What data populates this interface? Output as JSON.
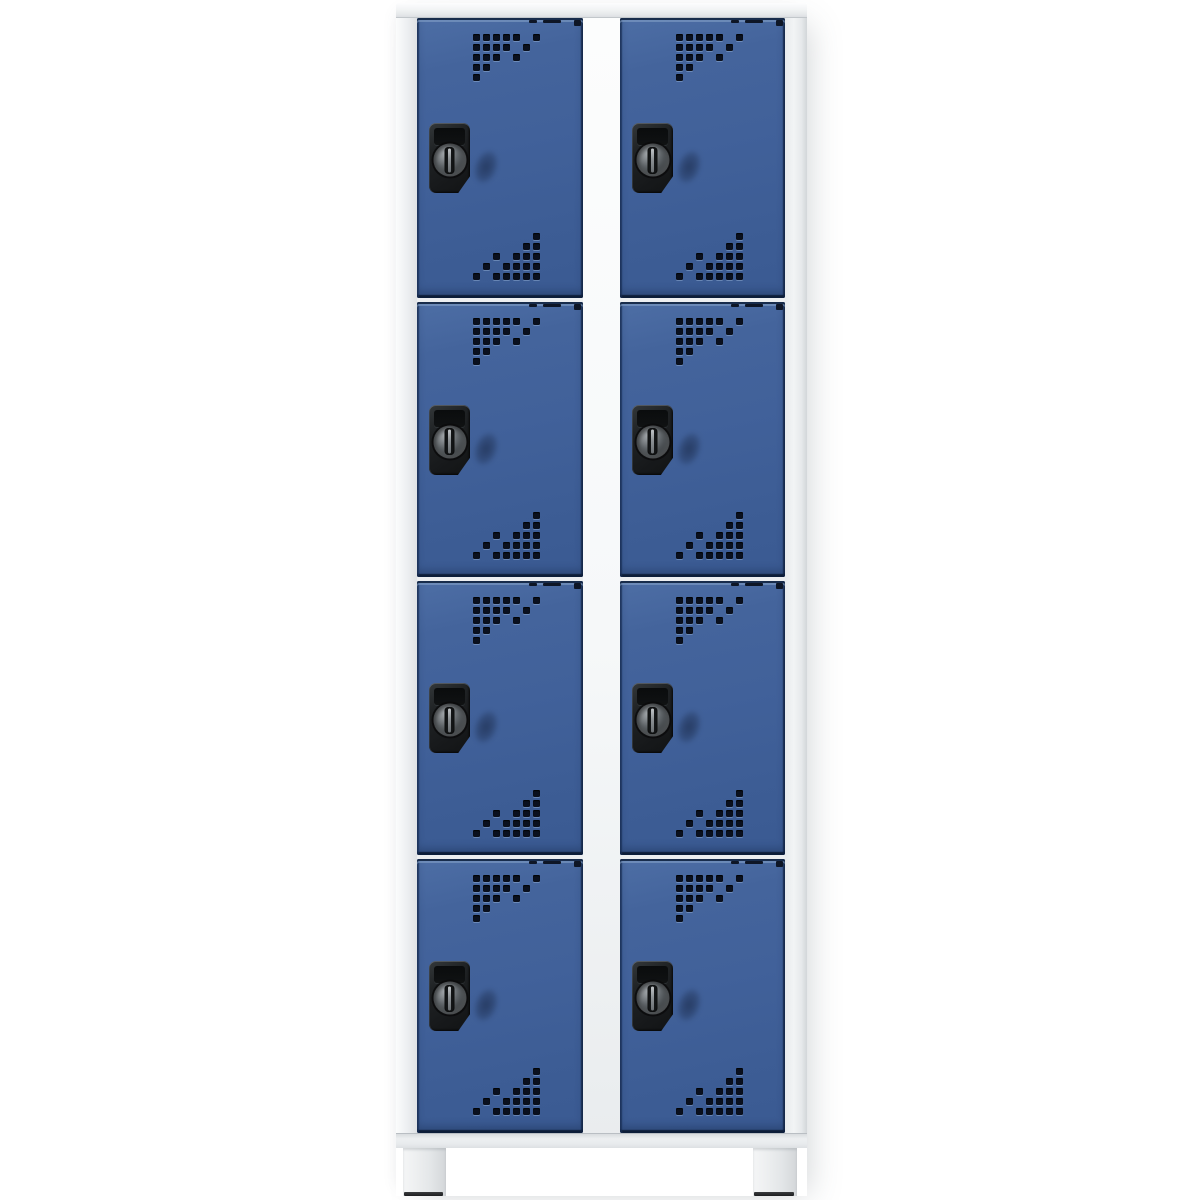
{
  "scene": {
    "description": "Grey steel compartment locker with two columns of four gentian-blue half-height doors, black rotary cylinder-lock handles, square ventilation perforations, and feet, on a plain white studio background",
    "background_color": "#ffffff"
  },
  "locker": {
    "columns": 2,
    "rows_per_column": 4,
    "total_compartments": 8,
    "visible_legs": 2,
    "handle_type": "rotary-cylinder-lock-handle",
    "vent_pattern_top": [
      "1111101",
      "1111010",
      "1110100",
      "1100000",
      "1000000"
    ],
    "vent_pattern_bottom": [
      "0000001",
      "0000011",
      "0010111",
      "0101111",
      "1011111"
    ]
  },
  "colors": {
    "background": "#ffffff",
    "frame_light": "#f2f4f5",
    "frame_shadow": "#d2d6d9",
    "door_blue": "#41619a",
    "door_blue_highlight": "#7e9cc6",
    "door_blue_shadow": "#16294d",
    "vent_hole_dark": "#0a101e",
    "handle_black": "#17191b",
    "knob_metal": "#8b9094",
    "leg_foot_dark": "#1c1d1f"
  }
}
